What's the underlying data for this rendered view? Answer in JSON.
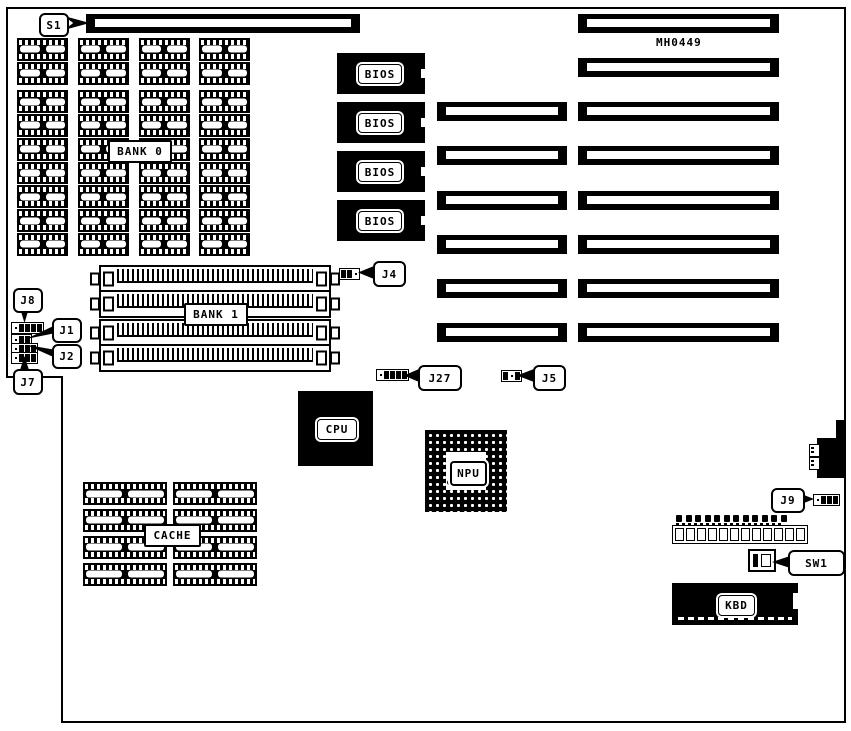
{
  "board": {
    "model_code": "MH0449",
    "labels": {
      "s1": "S1",
      "j1": "J1",
      "j2": "J2",
      "j4": "J4",
      "j5": "J5",
      "j7": "J7",
      "j8": "J8",
      "j9": "J9",
      "j27": "J27",
      "sw1": "SW1",
      "bank0": "BANK 0",
      "bank1": "BANK 1",
      "cache": "CACHE",
      "cpu": "CPU",
      "npu": "NPU",
      "kbd": "KBD",
      "bios": "BIOS"
    },
    "memory": {
      "bank0_columns": 4,
      "bank0_chips_per_column_top": 2,
      "bank0_chips_per_column_bottom": 7,
      "bank1_simm_sockets": 4,
      "cache_columns": 2,
      "cache_rows": 4
    },
    "bios_chip_count": 4,
    "expansion_slots": {
      "left_column": 6,
      "right_column": 8
    },
    "keyboard_header_positions": 12,
    "jumper_pin_patterns": {
      "j8_header": [
        "o",
        "f",
        "f",
        "f",
        "f"
      ],
      "j1_header": [
        "o",
        "f",
        "f"
      ],
      "j2_header": [
        "o",
        "f",
        "f",
        "f"
      ],
      "j7_header": [
        "o",
        "f",
        "f",
        "f"
      ],
      "j4": [
        "f",
        "f",
        "o"
      ],
      "j27": [
        "o",
        "f",
        "f",
        "f",
        "f"
      ],
      "j5": [
        "f",
        "o",
        "f"
      ],
      "j9": [
        "o",
        "f",
        "f",
        "f"
      ]
    },
    "colors": {
      "ink": "#000000",
      "paper": "#ffffff"
    }
  }
}
